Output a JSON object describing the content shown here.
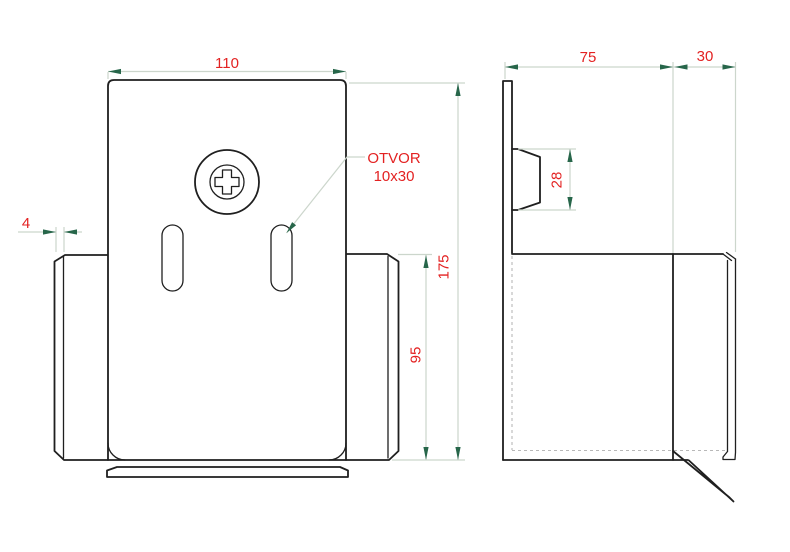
{
  "drawing": {
    "front_view": {
      "width_label": "110",
      "thickness_label": "4",
      "height_label": "175",
      "flange_height_label": "95",
      "hole_callout_line1": "OTVOR",
      "hole_callout_line2": "10x30"
    },
    "side_view": {
      "depth_label": "75",
      "flange_depth_label": "30",
      "tab_height_label": "28"
    },
    "colors": {
      "outline": "#1f1f1f",
      "dimension_line": "#ccd6cc",
      "arrow": "#27664a",
      "label_text": "#e32222",
      "hidden_line": "#b8b8b8",
      "background": "#ffffff"
    }
  }
}
